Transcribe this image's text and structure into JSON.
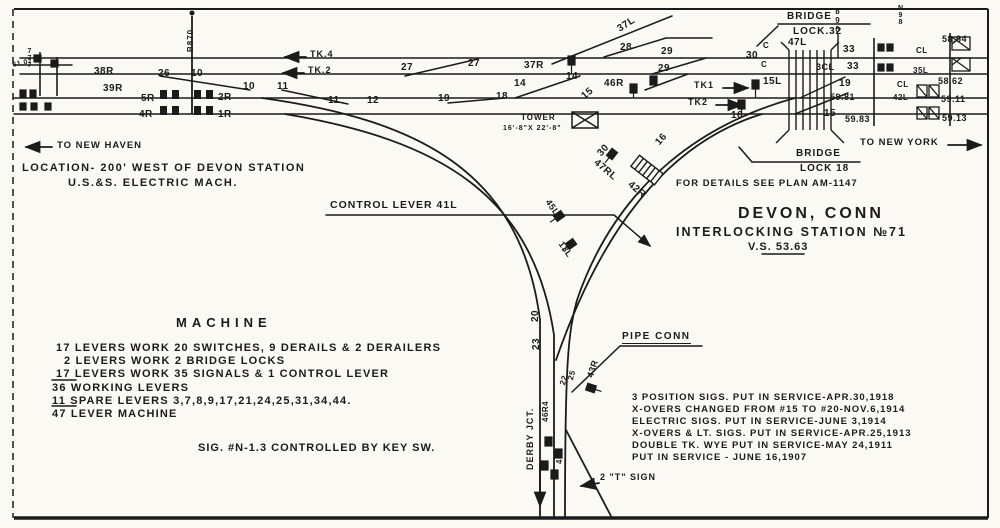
{
  "colors": {
    "paper": "#faf9f4",
    "ink": "#1b1b1b"
  },
  "title": {
    "line1": "DEVON, CONN",
    "line2": "INTERLOCKING STATION №71",
    "line3": "V.S. 53.63"
  },
  "labels": {
    "to_new_haven": "TO NEW HAVEN",
    "to_new_york": "TO NEW YORK",
    "location_line1": "LOCATION- 200' WEST OF DEVON STATION",
    "location_line2": "U.S.&S. ELECTRIC MACH.",
    "control_lever": "CONTROL LEVER 41L",
    "pipe_conn": "PIPE CONN",
    "for_details": "FOR DETAILS SEE PLAN AM-1147",
    "bridge_lock_32_line1": "BRIDGE",
    "bridge_lock_32_line2": "LOCK.32",
    "bridge_lock_18_line1": "BRIDGE",
    "bridge_lock_18_line2": "LOCK 18",
    "tower_name": "TOWER",
    "tower_dims": "16'-8\"X 22'-8\"",
    "tk4": "TK.4",
    "tk2": "TK.2",
    "tk1_right": "TK1",
    "tk2_right": "TK2",
    "derby_jct": "DERBY JCT.",
    "t_sign": "2 \"T\" SIGN",
    "b870": "B870",
    "lever_47l": "47L"
  },
  "machine": {
    "heading": "MACHINE",
    "lines": [
      "17 LEVERS WORK 20 SWITCHES, 9 DERAILS & 2 DERAILERS",
      "2 LEVERS WORK 2 BRIDGE LOCKS",
      "17 LEVERS WORK 35 SIGNALS & 1 CONTROL LEVER",
      "36 WORKING LEVERS",
      "11 SPARE LEVERS 3,7,8,9,17,21,24,25,31,34,44.",
      "47 LEVER MACHINE"
    ],
    "footnote": "SIG. #N-1.3 CONTROLLED BY KEY SW."
  },
  "service_notes": {
    "lines": [
      "3 POSITION SIGS. PUT IN SERVICE-APR.30,1918",
      "X-OVERS CHANGED FROM #15 TO #20-NOV.6,1914",
      "ELECTRIC SIGS. PUT IN SERVICE-JUNE 3,1914",
      "X-OVERS & LT. SIGS. PUT IN SERVICE-APR.25,1913",
      "DOUBLE TK. WYE PUT IN SERVICE-MAY 24,1911",
      "PUT IN SERVICE - JUNE 16,1907"
    ]
  },
  "annotations": [
    {
      "t": "26",
      "x": 158,
      "y": 69
    },
    {
      "t": "10",
      "x": 191,
      "y": 69
    },
    {
      "t": "10",
      "x": 243,
      "y": 82
    },
    {
      "t": "11",
      "x": 277,
      "y": 82
    },
    {
      "t": "11",
      "x": 328,
      "y": 96
    },
    {
      "t": "12",
      "x": 367,
      "y": 96
    },
    {
      "t": "27",
      "x": 401,
      "y": 63
    },
    {
      "t": "27",
      "x": 468,
      "y": 59
    },
    {
      "t": "19",
      "x": 438,
      "y": 94
    },
    {
      "t": "18",
      "x": 496,
      "y": 92
    },
    {
      "t": "14",
      "x": 514,
      "y": 79
    },
    {
      "t": "14",
      "x": 566,
      "y": 72
    },
    {
      "t": "15",
      "x": 580,
      "y": 94,
      "r": -40
    },
    {
      "t": "37R",
      "x": 524,
      "y": 61
    },
    {
      "t": "46R",
      "x": 604,
      "y": 79
    },
    {
      "t": "37L",
      "x": 616,
      "y": 26,
      "r": -33
    },
    {
      "t": "28",
      "x": 620,
      "y": 43
    },
    {
      "t": "29",
      "x": 661,
      "y": 47
    },
    {
      "t": "29",
      "x": 658,
      "y": 64
    },
    {
      "t": "30",
      "x": 746,
      "y": 51
    },
    {
      "t": "C",
      "x": 763,
      "y": 42,
      "s": 8
    },
    {
      "t": "C",
      "x": 761,
      "y": 61,
      "s": 8
    },
    {
      "t": "47L",
      "x": 788,
      "y": 38
    },
    {
      "t": "33",
      "x": 843,
      "y": 45
    },
    {
      "t": "3CL",
      "x": 816,
      "y": 63,
      "s": 9
    },
    {
      "t": "33",
      "x": 847,
      "y": 62
    },
    {
      "t": "19",
      "x": 839,
      "y": 79
    },
    {
      "t": "59.81",
      "x": 830,
      "y": 93,
      "s": 9
    },
    {
      "t": "15",
      "x": 824,
      "y": 109
    },
    {
      "t": "59.83",
      "x": 845,
      "y": 115,
      "s": 9
    },
    {
      "t": "15L",
      "x": 763,
      "y": 77
    },
    {
      "t": "16",
      "x": 731,
      "y": 111
    },
    {
      "t": "CL",
      "x": 916,
      "y": 47,
      "s": 8
    },
    {
      "t": "35L",
      "x": 913,
      "y": 67,
      "s": 8
    },
    {
      "t": "CL",
      "x": 897,
      "y": 81,
      "s": 8
    },
    {
      "t": "42L",
      "x": 893,
      "y": 94,
      "s": 8
    },
    {
      "t": "58.64",
      "x": 942,
      "y": 35,
      "s": 9
    },
    {
      "t": "58.62",
      "x": 938,
      "y": 77,
      "s": 9
    },
    {
      "t": "59.11",
      "x": 941,
      "y": 95,
      "s": 9
    },
    {
      "t": "59.13",
      "x": 942,
      "y": 114,
      "s": 9
    },
    {
      "t": "5R",
      "x": 141,
      "y": 94
    },
    {
      "t": "2R",
      "x": 218,
      "y": 93
    },
    {
      "t": "4R",
      "x": 139,
      "y": 110
    },
    {
      "t": "1R",
      "x": 218,
      "y": 110
    },
    {
      "t": "38R",
      "x": 94,
      "y": 67
    },
    {
      "t": "39R",
      "x": 103,
      "y": 84
    },
    {
      "t": "30",
      "x": 596,
      "y": 152,
      "r": -48
    },
    {
      "t": "16",
      "x": 654,
      "y": 141,
      "r": -48
    },
    {
      "t": "47RL",
      "x": 598,
      "y": 158,
      "r": 40
    },
    {
      "t": "42R",
      "x": 632,
      "y": 180,
      "r": 40
    },
    {
      "t": "45L",
      "x": 551,
      "y": 198,
      "r": 55,
      "s": 9
    },
    {
      "t": "13L",
      "x": 564,
      "y": 240,
      "r": 55,
      "s": 9
    },
    {
      "t": "20",
      "x": 531,
      "y": 322,
      "r": -90
    },
    {
      "t": "23",
      "x": 532,
      "y": 350,
      "r": -90
    },
    {
      "t": "22",
      "x": 559,
      "y": 384,
      "r": -75,
      "s": 8
    },
    {
      "t": "25",
      "x": 567,
      "y": 379,
      "r": -75,
      "s": 8
    },
    {
      "t": "43R",
      "x": 586,
      "y": 376,
      "r": -72,
      "s": 9
    },
    {
      "t": "46R4",
      "x": 542,
      "y": 422,
      "r": -90,
      "s": 8
    },
    {
      "t": "40R",
      "x": 556,
      "y": 464,
      "r": -90,
      "s": 8
    },
    {
      "t": "777",
      "x": 26,
      "y": 48,
      "st": 1,
      "s": 7
    },
    {
      "t": "61.07",
      "x": 12,
      "y": 62,
      "r": -12,
      "s": 7
    },
    {
      "t": "890",
      "x": 833,
      "y": 7,
      "st": 1,
      "s": 8
    },
    {
      "t": "N98",
      "x": 897,
      "y": 5,
      "st": 1,
      "s": 7
    }
  ]
}
